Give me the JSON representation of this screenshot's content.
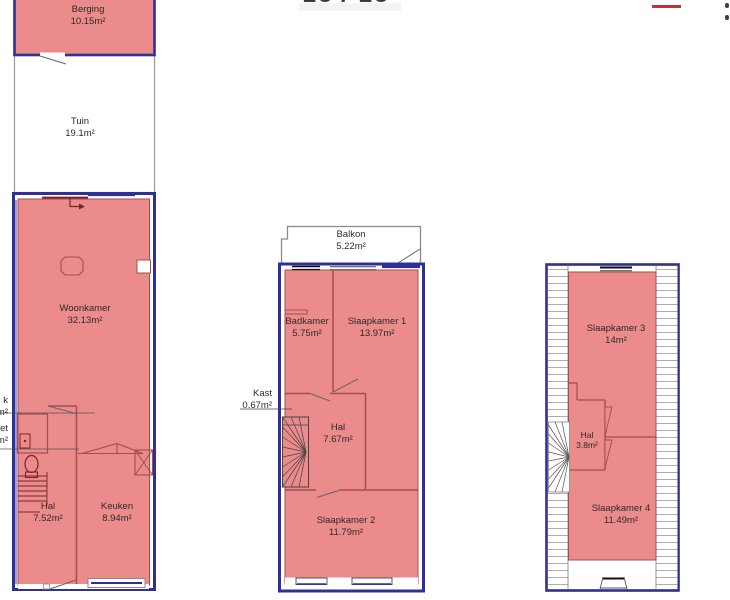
{
  "header": {
    "cropped_title": "234-23",
    "red_mark_color": "#c23434"
  },
  "colors": {
    "room_fill": "#ec8b8b",
    "room_outline": "#a34d4d",
    "wall": "#2f2f96",
    "exterior_outline": "#8a8a8a"
  },
  "floors": [
    {
      "name": "ground-floor",
      "rooms": [
        {
          "name": "Berging",
          "area": "10.15m²"
        },
        {
          "name": "Tuin",
          "area": "19.1m²"
        },
        {
          "name": "Woonkamer",
          "area": "32.13m²"
        },
        {
          "name": "Hal",
          "area": "7.52m²"
        },
        {
          "name": "Keuken",
          "area": "8.94m²"
        }
      ],
      "cutoff_labels": [
        {
          "line1": "k",
          "line2": "m²"
        },
        {
          "line1": "et",
          "line2": "m²"
        }
      ]
    },
    {
      "name": "first-floor",
      "rooms": [
        {
          "name": "Balkon",
          "area": "5.22m²"
        },
        {
          "name": "Badkamer",
          "area": "5.75m²"
        },
        {
          "name": "Slaapkamer 1",
          "area": "13.97m²"
        },
        {
          "name": "Kast",
          "area": "0.67m²"
        },
        {
          "name": "Hal",
          "area": "7.67m²"
        },
        {
          "name": "Slaapkamer 2",
          "area": "11.79m²"
        }
      ]
    },
    {
      "name": "second-floor",
      "rooms": [
        {
          "name": "Slaapkamer 3",
          "area": "14m²"
        },
        {
          "name": "Hal",
          "area": "3.8m²"
        },
        {
          "name": "Slaapkamer 4",
          "area": "11.49m²"
        }
      ]
    }
  ]
}
